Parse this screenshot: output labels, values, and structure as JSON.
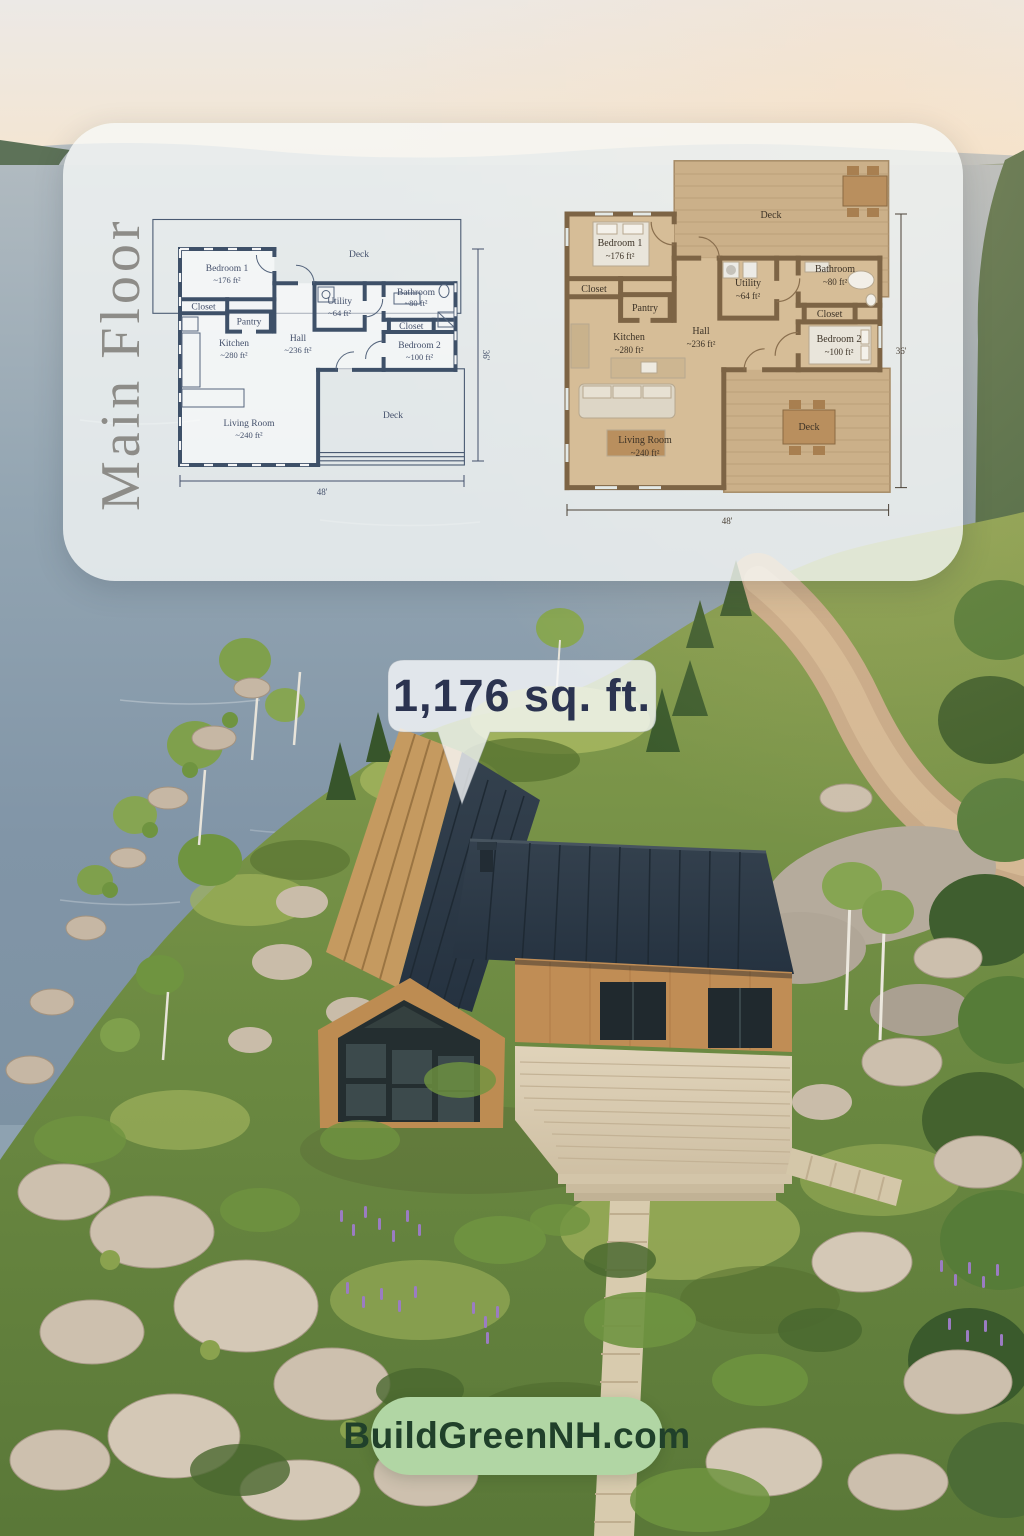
{
  "panel": {
    "title": "Main Floor"
  },
  "plan": {
    "rooms": {
      "deck_top": {
        "name": "Deck"
      },
      "bedroom1": {
        "name": "Bedroom 1",
        "area": "~176 ft²"
      },
      "closet1": {
        "name": "Closet"
      },
      "pantry": {
        "name": "Pantry"
      },
      "kitchen": {
        "name": "Kitchen",
        "area": "~280 ft²"
      },
      "hall": {
        "name": "Hall",
        "area": "~236 ft²"
      },
      "utility": {
        "name": "Utility",
        "area": "~64 ft²"
      },
      "bathroom": {
        "name": "Bathroom",
        "area": "~80 ft²"
      },
      "closet2": {
        "name": "Closet"
      },
      "bedroom2": {
        "name": "Bedroom 2",
        "area": "~100 ft²"
      },
      "living_room": {
        "name": "Living Room",
        "area": "~240 ft²"
      },
      "deck_bottom": {
        "name": "Deck"
      }
    },
    "dimensions": {
      "width": "48'",
      "height": "36'"
    }
  },
  "callout": {
    "label": "1,176 sq. ft."
  },
  "badge": {
    "label": "BuildGreenNH.com"
  },
  "colors": {
    "blueprint_wall": "#3e5068",
    "plan_floor": "#d6bd97",
    "plan_wall": "#7d6445",
    "callout_text": "#2b3350",
    "badge_bg": "#b1d6a4",
    "badge_text": "#20402a",
    "roof": "#2c3844",
    "siding": "#c08d55",
    "deck_wood": "#dbcfb6",
    "panel_title": "#8d8c88"
  }
}
